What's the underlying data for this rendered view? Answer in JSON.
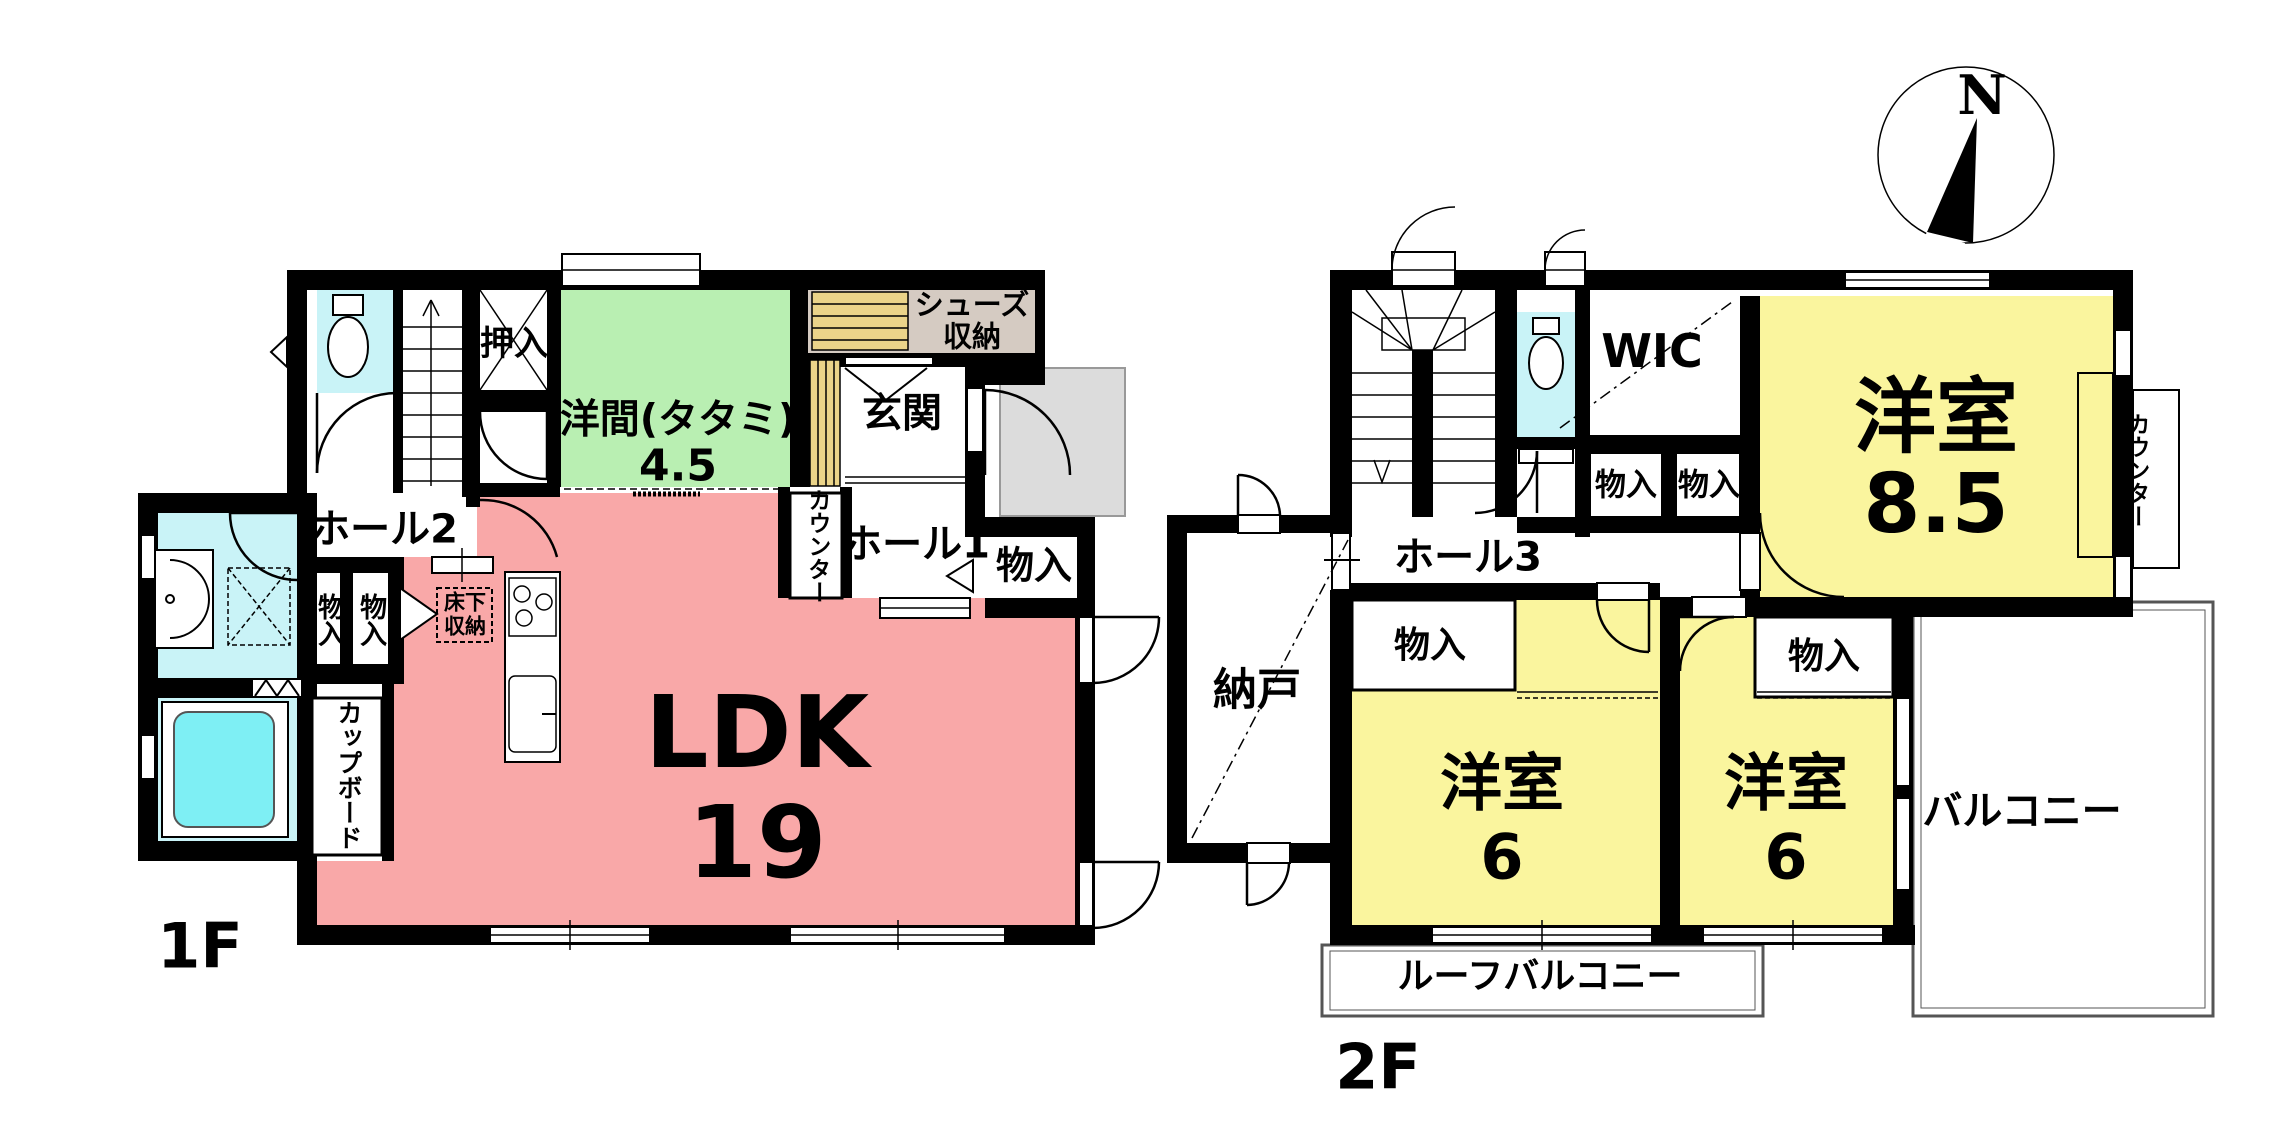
{
  "document": {
    "type": "floor-plan",
    "description": "2-story house floor plan"
  },
  "compass": {
    "north": "N"
  },
  "colors": {
    "ldk_pink": "#F9A8A8",
    "tatami_green": "#B9EFB2",
    "room_yellow": "#FAF59E",
    "wet_cyan": "#C9F3F7",
    "bathtub_cyan": "#7EEFF4",
    "shelf_tan": "#EBD489",
    "shoe_label_beige": "#D5CBC2",
    "porch_gray": "#DCDCDC",
    "wall_black": "#000000",
    "balcony_line": "#555555"
  },
  "floor1": {
    "floor_label": "1F",
    "rooms": {
      "ldk": {
        "name": "LDK",
        "size": "19"
      },
      "youma": {
        "name": "洋間(タタミ)",
        "size": "4.5"
      },
      "genkan": "玄関",
      "hall1": "ホール1",
      "hall2": "ホール2",
      "oshiire": "押入",
      "shoes_storage": "シューズ\n収納",
      "counter": "カウンター",
      "monoire_hall1": "物入",
      "monoire_a": "物入",
      "monoire_b": "物入",
      "yukashita_storage": "床下\n収納",
      "cupboard": "カップボード"
    }
  },
  "floor2": {
    "floor_label": "2F",
    "rooms": {
      "yoshitsu_85": {
        "name": "洋室",
        "size": "8.5"
      },
      "yoshitsu_6_left": {
        "name": "洋室",
        "size": "6"
      },
      "yoshitsu_6_right": {
        "name": "洋室",
        "size": "6"
      },
      "wic": "WIC",
      "hall3": "ホール3",
      "nando": "納戸",
      "counter": "カウンター",
      "monoire_1": "物入",
      "monoire_2": "物入",
      "monoire_left_room": "物入",
      "monoire_right_room": "物入",
      "balcony": "バルコニー",
      "roof_balcony": "ルーフバルコニー"
    }
  }
}
